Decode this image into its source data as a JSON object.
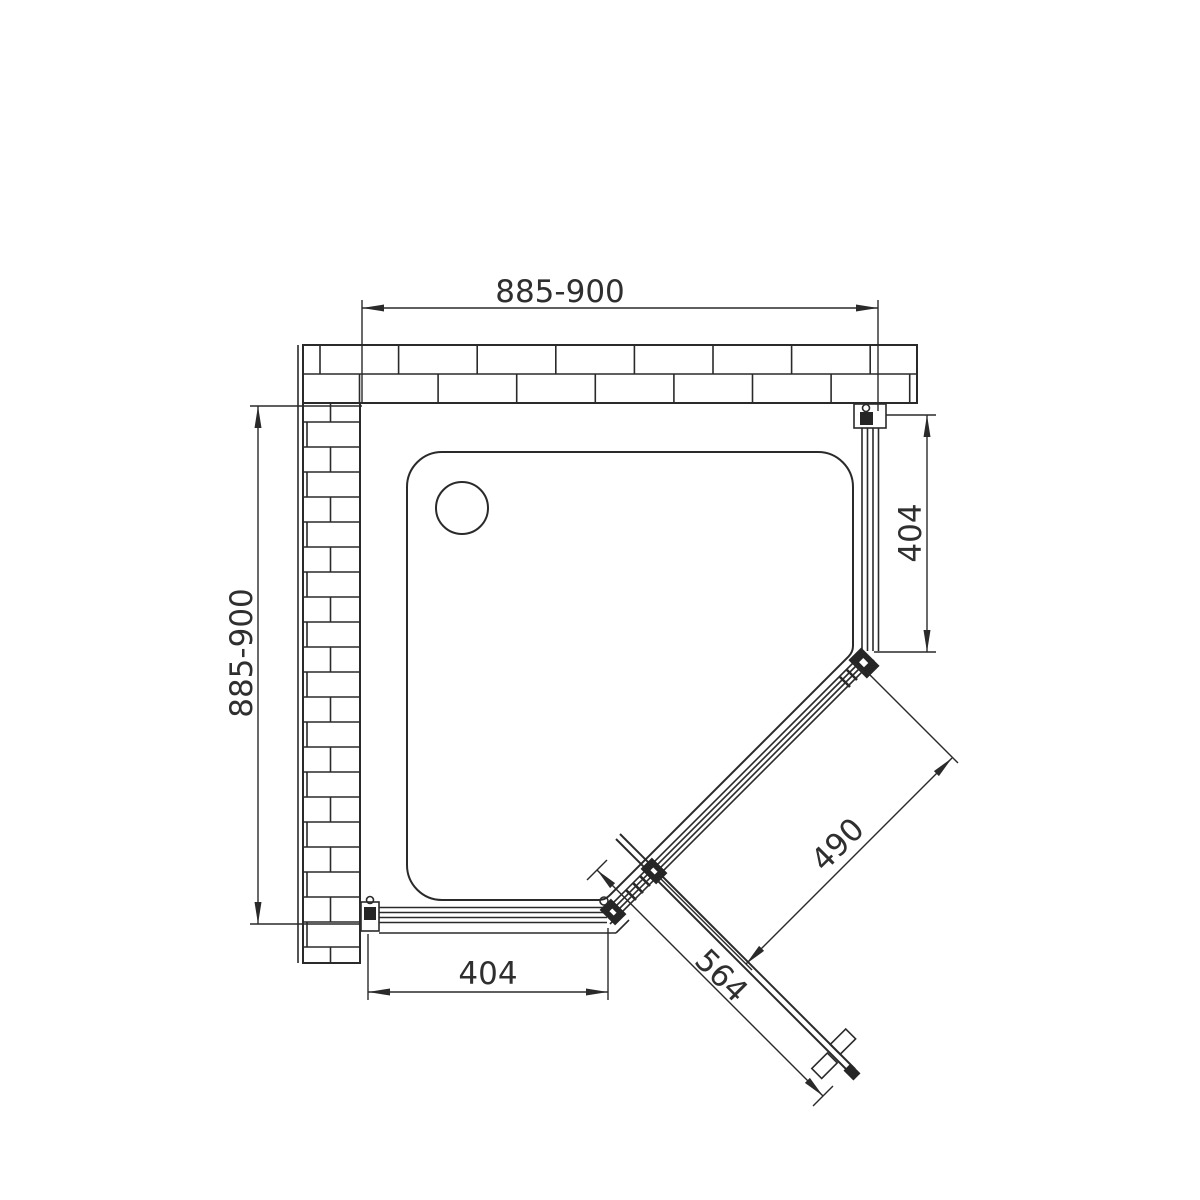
{
  "drawing": {
    "kind": "shower-enclosure-pentagonal-plan"
  },
  "dimensions": {
    "top_width": "885-900",
    "left_depth": "885-900",
    "right_panel_width": "404",
    "bottom_panel_width": "404",
    "door_opening": "490",
    "door_width": "564"
  },
  "colors": {
    "line": "#2a2a2a",
    "background": "#ffffff"
  }
}
